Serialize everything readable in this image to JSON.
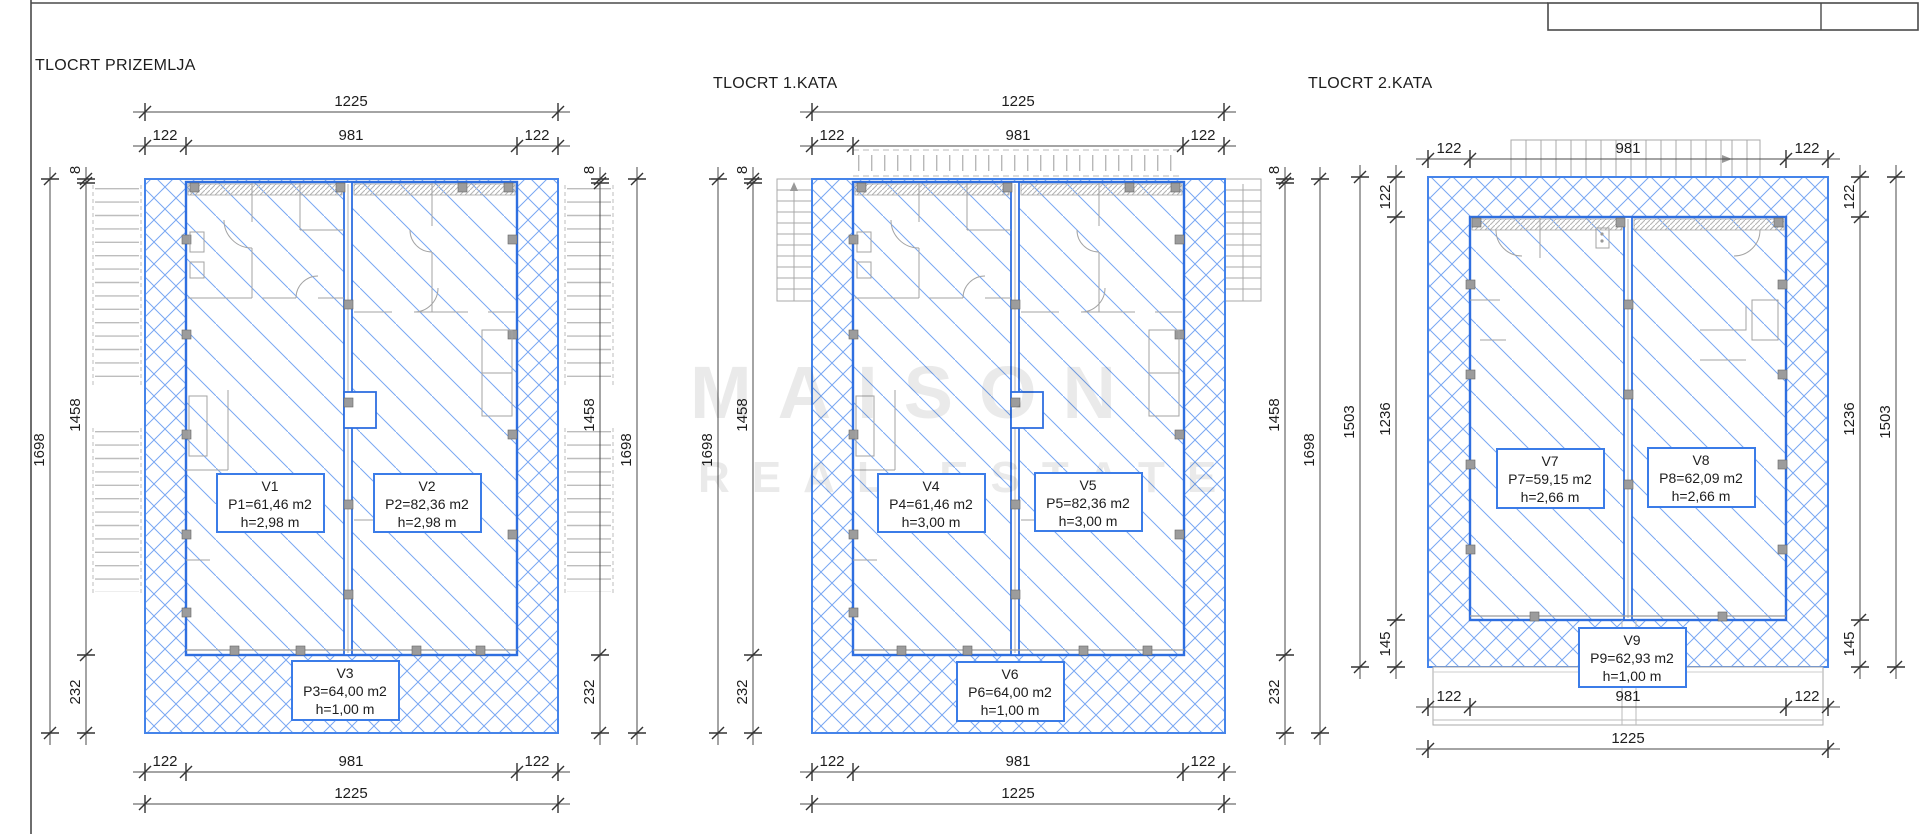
{
  "watermark": {
    "line1": "MAISON",
    "line2": "REAL ESTATE"
  },
  "plans": [
    {
      "title": "TLOCRT PRIZEMLJA",
      "dims": {
        "top_total": "1225",
        "top_a": "122",
        "top_b": "981",
        "top_c": "122",
        "bot_a": "122",
        "bot_b": "981",
        "bot_c": "122",
        "bot_total": "1225",
        "l_outer": "1698",
        "l_a": "8",
        "l_b": "1458",
        "l_c": "232",
        "r_a": "8",
        "r_b": "1458",
        "r_c": "232",
        "r_outer": "1698"
      },
      "units": [
        {
          "name": "V1",
          "area": "P1=61,46 m2",
          "height": "h=2,98 m"
        },
        {
          "name": "V2",
          "area": "P2=82,36 m2",
          "height": "h=2,98 m"
        },
        {
          "name": "V3",
          "area": "P3=64,00 m2",
          "height": "h=1,00 m"
        }
      ]
    },
    {
      "title": "TLOCRT 1.KATA",
      "dims": {
        "top_total": "1225",
        "top_a": "122",
        "top_b": "981",
        "top_c": "122",
        "bot_a": "122",
        "bot_b": "981",
        "bot_c": "122",
        "bot_total": "1225",
        "l_outer": "1698",
        "l_a": "8",
        "l_b": "1458",
        "l_c": "232",
        "r_a": "8",
        "r_b": "1458",
        "r_c": "232",
        "r_outer": "1698"
      },
      "units": [
        {
          "name": "V4",
          "area": "P4=61,46 m2",
          "height": "h=3,00 m"
        },
        {
          "name": "V5",
          "area": "P5=82,36 m2",
          "height": "h=3,00 m"
        },
        {
          "name": "V6",
          "area": "P6=64,00 m2",
          "height": "h=1,00 m"
        }
      ]
    },
    {
      "title": "TLOCRT 2.KATA",
      "dims": {
        "top_a": "122",
        "top_b": "981",
        "top_c": "122",
        "bot_a": "122",
        "bot_b": "981",
        "bot_c": "122",
        "bot_total": "1225",
        "l_outer": "1503",
        "l_a": "122",
        "l_b": "1236",
        "l_c": "145",
        "r_a": "122",
        "r_b": "1236",
        "r_c": "145",
        "r_outer": "1503"
      },
      "units": [
        {
          "name": "V7",
          "area": "P7=59,15 m2",
          "height": "h=2,66 m"
        },
        {
          "name": "V8",
          "area": "P8=62,09 m2",
          "height": "h=2,66 m"
        },
        {
          "name": "V9",
          "area": "P9=62,93 m2",
          "height": "h=1,00 m"
        }
      ]
    }
  ]
}
